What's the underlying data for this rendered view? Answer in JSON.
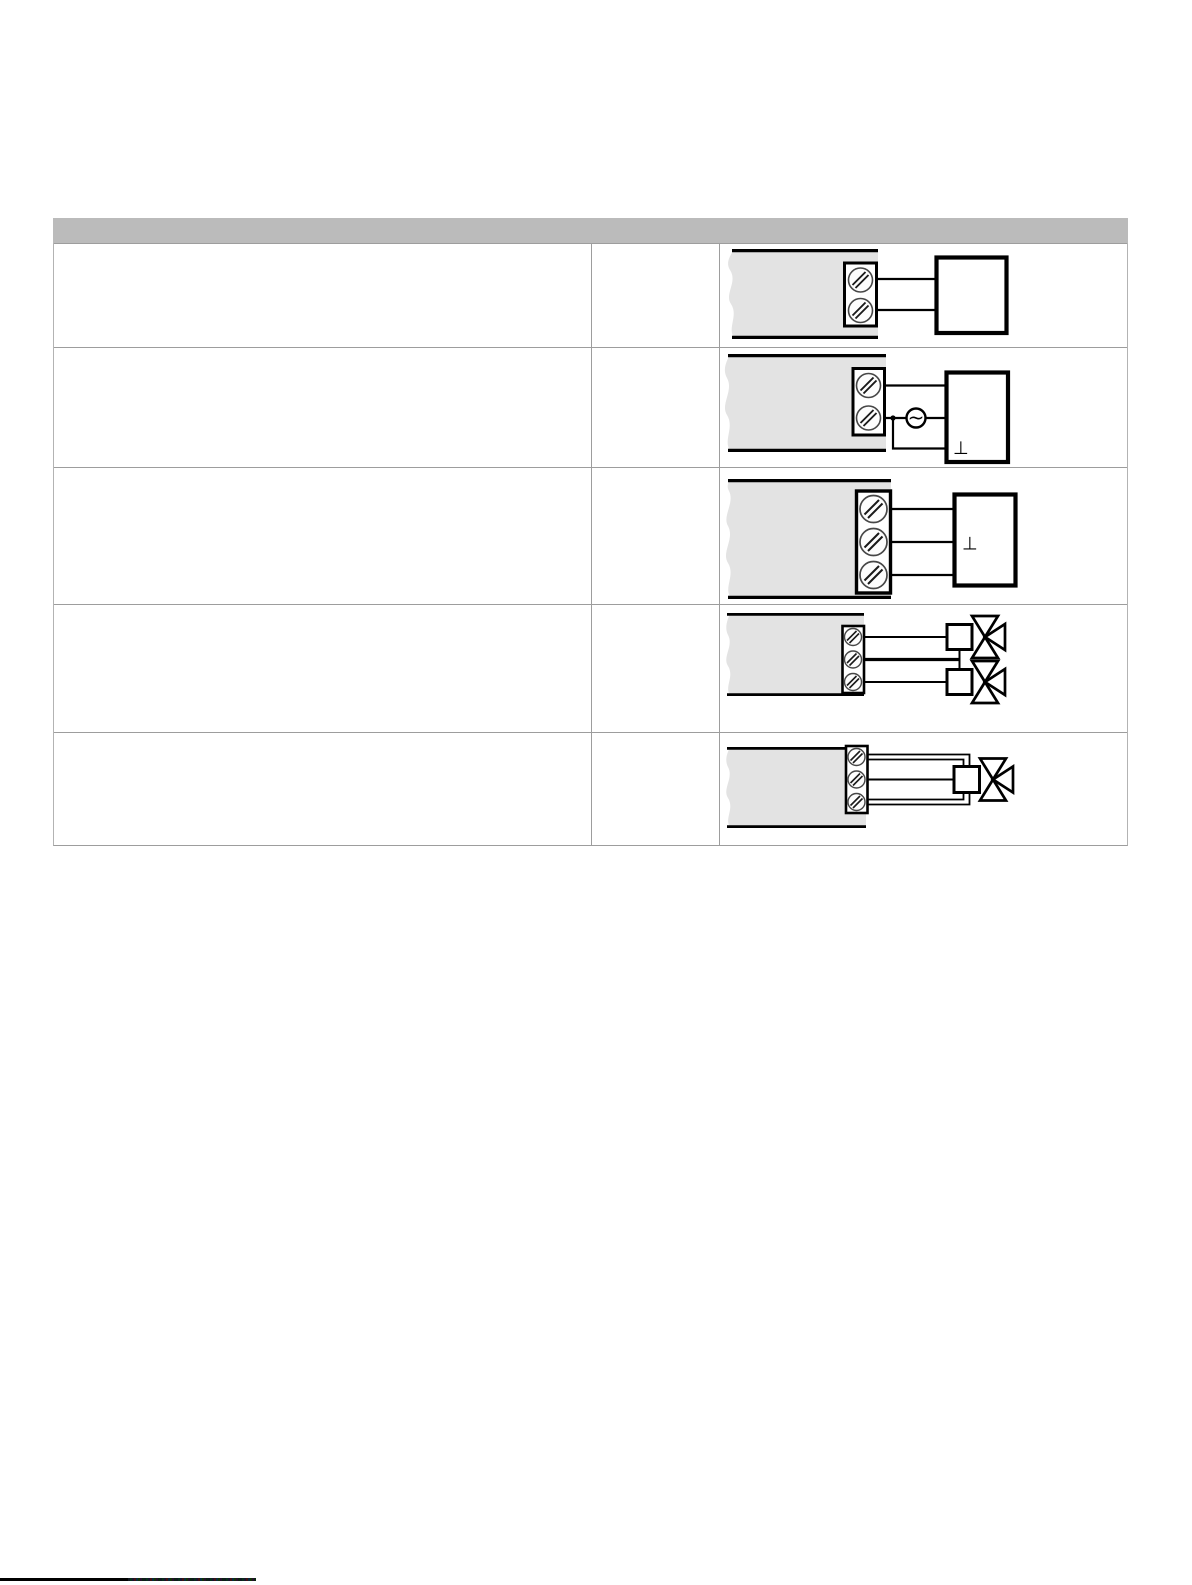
{
  "page": {
    "width": 1192,
    "height": 1585,
    "background": "#ffffff"
  },
  "colors": {
    "header_bar": "#bbbbbb",
    "table_border": "#9d9d9d",
    "controller_panel_fill": "#e3e3e3",
    "diagram_stroke": "#000000",
    "footer_bar": "#000000"
  },
  "symbols": {
    "ground": "⊥",
    "ac_source": "~"
  },
  "table": {
    "header_label": "",
    "rows": [
      {
        "description": "",
        "reference": "",
        "diagram_icon": "controller-two-terminals-to-device"
      },
      {
        "description": "",
        "reference": "",
        "diagram_icon": "controller-two-terminals-ac-source-grounded-device"
      },
      {
        "description": "",
        "reference": "",
        "diagram_icon": "controller-three-terminals-to-grounded-device"
      },
      {
        "description": "",
        "reference": "",
        "diagram_icon": "controller-three-terminals-to-two-valve-actuators"
      },
      {
        "description": "",
        "reference": "",
        "diagram_icon": "controller-three-terminals-to-single-valve-actuator"
      }
    ]
  }
}
